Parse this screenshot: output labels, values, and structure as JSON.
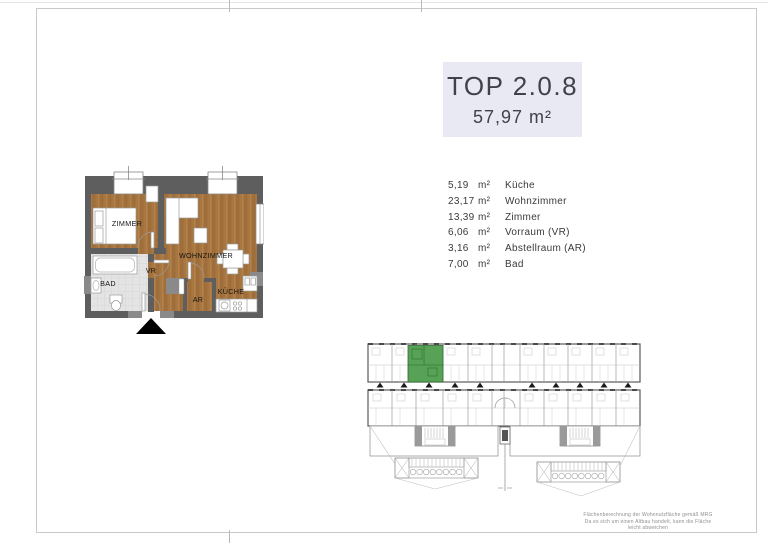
{
  "page": {
    "title": "TOP 2.0.8",
    "total_area": "57,97 m²"
  },
  "rooms": [
    {
      "area": "5,19",
      "unit": "m²",
      "name": "Küche"
    },
    {
      "area": "23,17",
      "unit": "m²",
      "name": "Wohnzimmer"
    },
    {
      "area": "13,39",
      "unit": "m²",
      "name": "Zimmer"
    },
    {
      "area": "6,06",
      "unit": "m²",
      "name": "Vorraum (VR)"
    },
    {
      "area": "3,16",
      "unit": "m²",
      "name": "Abstellraum (AR)"
    },
    {
      "area": "7,00",
      "unit": "m²",
      "name": "Bad"
    }
  ],
  "floor_plan": {
    "labels": {
      "zimmer": "ZIMMER",
      "wohnzimmer": "WOHNZIMMER",
      "vorraum": "VR",
      "bad": "BAD",
      "abstellraum": "AR",
      "kueche": "KÜCHE"
    }
  },
  "site_plan": {
    "highlight_color": "#57a257"
  },
  "footer": {
    "line1": "Flächenberechnung der Wohnnutzfläche gemäß MRG",
    "line2": "Da es sich um einen Altbau handelt, kann die Fläche leicht abweichen"
  },
  "colors": {
    "title_bg": "#e9e9f3",
    "wall": "#5e5e5e",
    "wall_light": "#8a8a8a",
    "wood": "#a8763f",
    "tile": "#e4e4e4"
  }
}
